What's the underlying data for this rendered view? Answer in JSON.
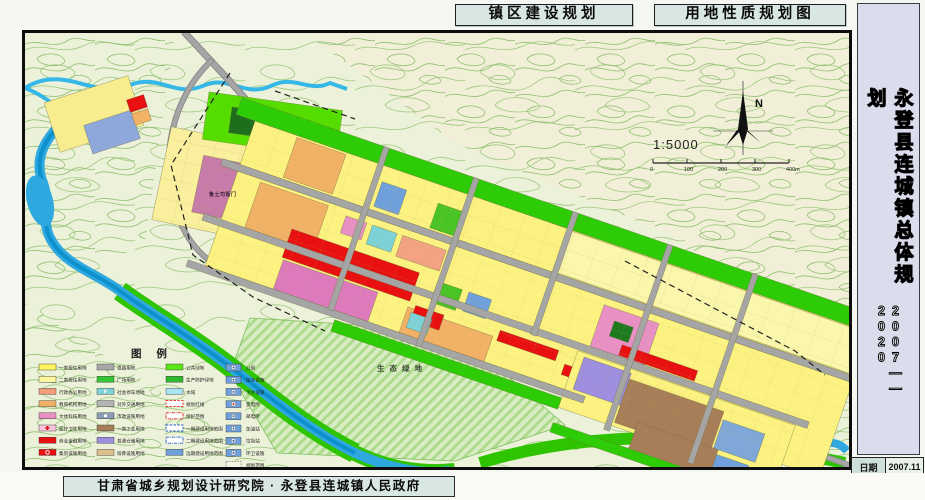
{
  "titles": {
    "left": "镇区建设规划",
    "right": "用地性质规划图"
  },
  "sidebar": {
    "title": "永登县连城镇总体规划",
    "years": "2007——2020"
  },
  "info_table": {
    "rows": [
      {
        "label": "日期",
        "value": "2007.11"
      },
      {
        "label": "图号",
        "value": "08"
      }
    ]
  },
  "footer": {
    "credit": "甘肃省城乡规划设计研究院 · 永登县连城镇人民政府"
  },
  "map": {
    "north_label": "N",
    "scale_text": "1:5000",
    "scale_ticks": [
      "0",
      "100",
      "200",
      "300",
      "400m"
    ],
    "labels": [
      {
        "text": "生态绿地",
        "x": 352,
        "y": 338,
        "fs": 7.5,
        "ls": 5,
        "color": "#3a4a33"
      },
      {
        "text": "鲁土司衙门",
        "x": 184,
        "y": 163,
        "fs": 5,
        "ls": 0.5,
        "color": "#40243a"
      }
    ],
    "legend": {
      "title": "图  例",
      "columns": [
        {
          "x": 14,
          "items": [
            {
              "label": "一类居住用地",
              "fill": "#FFF45C"
            },
            {
              "label": "二类居住用地",
              "fill": "#FBF59B"
            },
            {
              "label": "行政办公用地",
              "fill": "#F29E7B"
            },
            {
              "label": "教育机构用地",
              "fill": "#F1B166"
            },
            {
              "label": "文体科技用地",
              "fill": "#E88FC4"
            },
            {
              "label": "医疗卫生用地",
              "fill": "#F6C6D8",
              "sym": "cross"
            },
            {
              "label": "商业金融用地",
              "fill": "#E81010"
            },
            {
              "label": "集贸设施用地",
              "fill": "#E81010",
              "sym": "ring"
            }
          ]
        },
        {
          "x": 72,
          "items": [
            {
              "label": "道路用地",
              "fill": "#A8A8A8"
            },
            {
              "label": "广场用地",
              "fill": "#35C435"
            },
            {
              "label": "社会停车场地",
              "fill": "#7DD2D6",
              "sym": "P"
            },
            {
              "label": "对外交通用地",
              "fill": "#B5B5B5"
            },
            {
              "label": "市政设施用地",
              "fill": "#8A9BB5",
              "sym": "dot"
            },
            {
              "label": "一类工业用地",
              "fill": "#A87E58"
            },
            {
              "label": "普通仓储用地",
              "fill": "#9E8EDF"
            },
            {
              "label": "殡葬设施用地",
              "fill": "#D9C08A"
            }
          ]
        },
        {
          "x": 141,
          "items": [
            {
              "label": "公共绿地",
              "fill": "#5BE617"
            },
            {
              "label": "生产防护绿地",
              "fill": "#2FB82F"
            },
            {
              "label": "水域",
              "fill": "#A8E4F2"
            },
            {
              "label": "规划红线",
              "style": "dash",
              "color": "#E02020"
            },
            {
              "label": "保护范围",
              "style": "dashdot",
              "color": "#E02020"
            },
            {
              "label": "一期建设用地范围",
              "style": "dash",
              "color": "#2255CC"
            },
            {
              "label": "二期建设用地范围",
              "style": "dashdot",
              "color": "#2255CC"
            },
            {
              "label": "远期建设用地范围",
              "fill": "#6FA0DC"
            }
          ]
        },
        {
          "x": 201,
          "type": "symbols",
          "items": [
            {
              "label": "公厕"
            },
            {
              "label": "给水设施"
            },
            {
              "label": "污水设施"
            },
            {
              "label": "变电所",
              "symfill": "#E02020"
            },
            {
              "label": "邮电所"
            },
            {
              "label": "加油站"
            },
            {
              "label": "垃圾站"
            },
            {
              "label": "环卫设施"
            },
            {
              "label": "规划范围",
              "style": "dashbox"
            }
          ]
        }
      ]
    },
    "band_zones": [
      [
        -20,
        -18,
        680,
        18,
        "#2ECC06"
      ],
      [
        0,
        0,
        650,
        46,
        "#FBF281"
      ],
      [
        335,
        1,
        315,
        44,
        "#FAF6AB"
      ],
      [
        45,
        2,
        52,
        42,
        "#F1B166"
      ],
      [
        140,
        16,
        26,
        26,
        "#6FA0DC"
      ],
      [
        200,
        18,
        26,
        26,
        "#49C424"
      ],
      [
        0,
        53,
        650,
        100,
        "#FBF281"
      ],
      [
        25,
        56,
        72,
        48,
        "#F1B166"
      ],
      [
        117,
        60,
        22,
        18,
        "#E88FC4"
      ],
      [
        145,
        60,
        26,
        20,
        "#7DD2D6"
      ],
      [
        177,
        60,
        46,
        22,
        "#F3A284"
      ],
      [
        390,
        60,
        58,
        44,
        "#E88FC4"
      ],
      [
        405,
        72,
        20,
        16,
        "#1E7A1E"
      ],
      [
        70,
        90,
        135,
        30,
        "#E81010"
      ],
      [
        205,
        126,
        90,
        27,
        "#F1B166"
      ],
      [
        72,
        122,
        100,
        31,
        "#DD7ABB"
      ],
      [
        225,
        92,
        26,
        22,
        "#49C424"
      ],
      [
        258,
        92,
        24,
        20,
        "#6FA0DC"
      ],
      [
        212,
        122,
        30,
        16,
        "#E81010"
      ],
      [
        210,
        130,
        22,
        16,
        "#7DD2D6"
      ],
      [
        300,
        118,
        62,
        11,
        "#E81010"
      ],
      [
        372,
        129,
        72,
        11,
        "#E81010"
      ],
      [
        420,
        92,
        80,
        11,
        "#E81010"
      ],
      [
        380,
        112,
        230,
        60,
        "#FBF281"
      ],
      [
        388,
        116,
        50,
        34,
        "#9E8EDF"
      ],
      [
        438,
        122,
        100,
        46,
        "#A87E58"
      ],
      [
        540,
        130,
        44,
        30,
        "#7FA8D8"
      ],
      [
        460,
        160,
        85,
        30,
        "#A87E58"
      ],
      [
        545,
        165,
        34,
        24,
        "#6FA0DC"
      ],
      [
        140,
        162,
        240,
        12,
        "#2ECC06"
      ],
      [
        380,
        188,
        230,
        10,
        "#2ECC06"
      ],
      [
        -18,
        46,
        670,
        7,
        "#A5A5A5"
      ],
      [
        -18,
        104,
        640,
        7,
        "#A5A5A5"
      ],
      [
        -18,
        153,
        420,
        7,
        "#A5A5A5"
      ],
      [
        130,
        -18,
        6,
        172,
        "#A5A5A5"
      ],
      [
        225,
        -18,
        6,
        178,
        "#A5A5A5"
      ],
      [
        330,
        -18,
        6,
        130,
        "#A5A5A5"
      ],
      [
        430,
        -18,
        6,
        196,
        "#A5A5A5"
      ],
      [
        520,
        -18,
        6,
        200,
        "#A5A5A5"
      ]
    ],
    "static_zones": [
      [
        25,
        55,
        88,
        52,
        "#F7EC8E",
        -18
      ],
      [
        62,
        84,
        50,
        30,
        "#8FA8DC",
        -18
      ],
      [
        103,
        64,
        18,
        13,
        "#E81010",
        -18
      ],
      [
        108,
        78,
        17,
        12,
        "#F1B166",
        -18
      ],
      [
        135,
        108,
        148,
        95,
        "#F9EF9C",
        12
      ],
      [
        172,
        128,
        62,
        58,
        "#C77BA8",
        12
      ],
      [
        180,
        68,
        135,
        48,
        "#55DD00",
        8
      ],
      [
        205,
        78,
        60,
        26,
        "#1E6E1E",
        8
      ]
    ]
  }
}
